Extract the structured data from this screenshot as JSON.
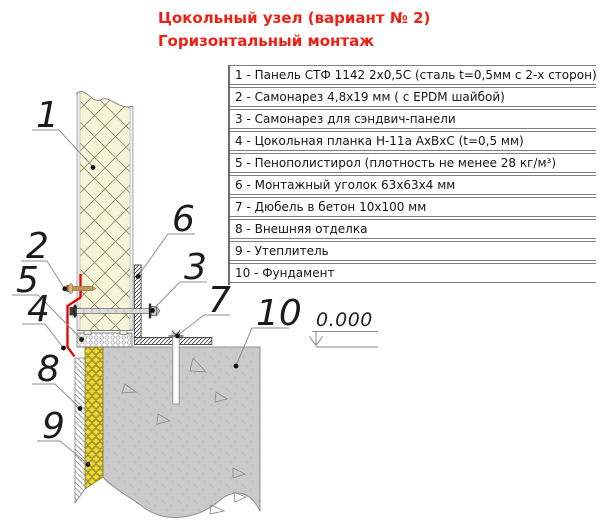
{
  "title": {
    "line1": "Цокольный узел (вариант № 2)",
    "line2": "Горизонтальный монтаж",
    "color": "#f01f14"
  },
  "legend": {
    "items": [
      "1 - Панель СТФ 1142 2х0,5С (сталь t=0,5мм с 2-х сторон)",
      "2 - Самонарез 4,8х19 мм ( с EPDM шайбой)",
      "3 - Самонарез для сэндвич-панели",
      "4 - Цокольная планка Н-11а АхВхС (t=0,5 мм)",
      "5 - Пенополистирол (плотность не менее 28 кг/м³)",
      "6 - Монтажный уголок 63х63х4 мм",
      "7 - Дюбель в бетон 10х100 мм",
      "8 - Внешняя отделка",
      "9 - Утеплитель",
      "10 - Фундамент"
    ]
  },
  "diagram": {
    "elevation": "0.000",
    "callouts": [
      {
        "num": "1"
      },
      {
        "num": "2"
      },
      {
        "num": "3"
      },
      {
        "num": "4"
      },
      {
        "num": "5"
      },
      {
        "num": "6"
      },
      {
        "num": "7"
      },
      {
        "num": "8"
      },
      {
        "num": "9"
      },
      {
        "num": "10"
      }
    ],
    "colors": {
      "flashing_red": "#e90000",
      "panel_core": "#f6f5d8",
      "insulation_yellow": "#eed937",
      "concrete_gray": "#cacaca"
    }
  }
}
